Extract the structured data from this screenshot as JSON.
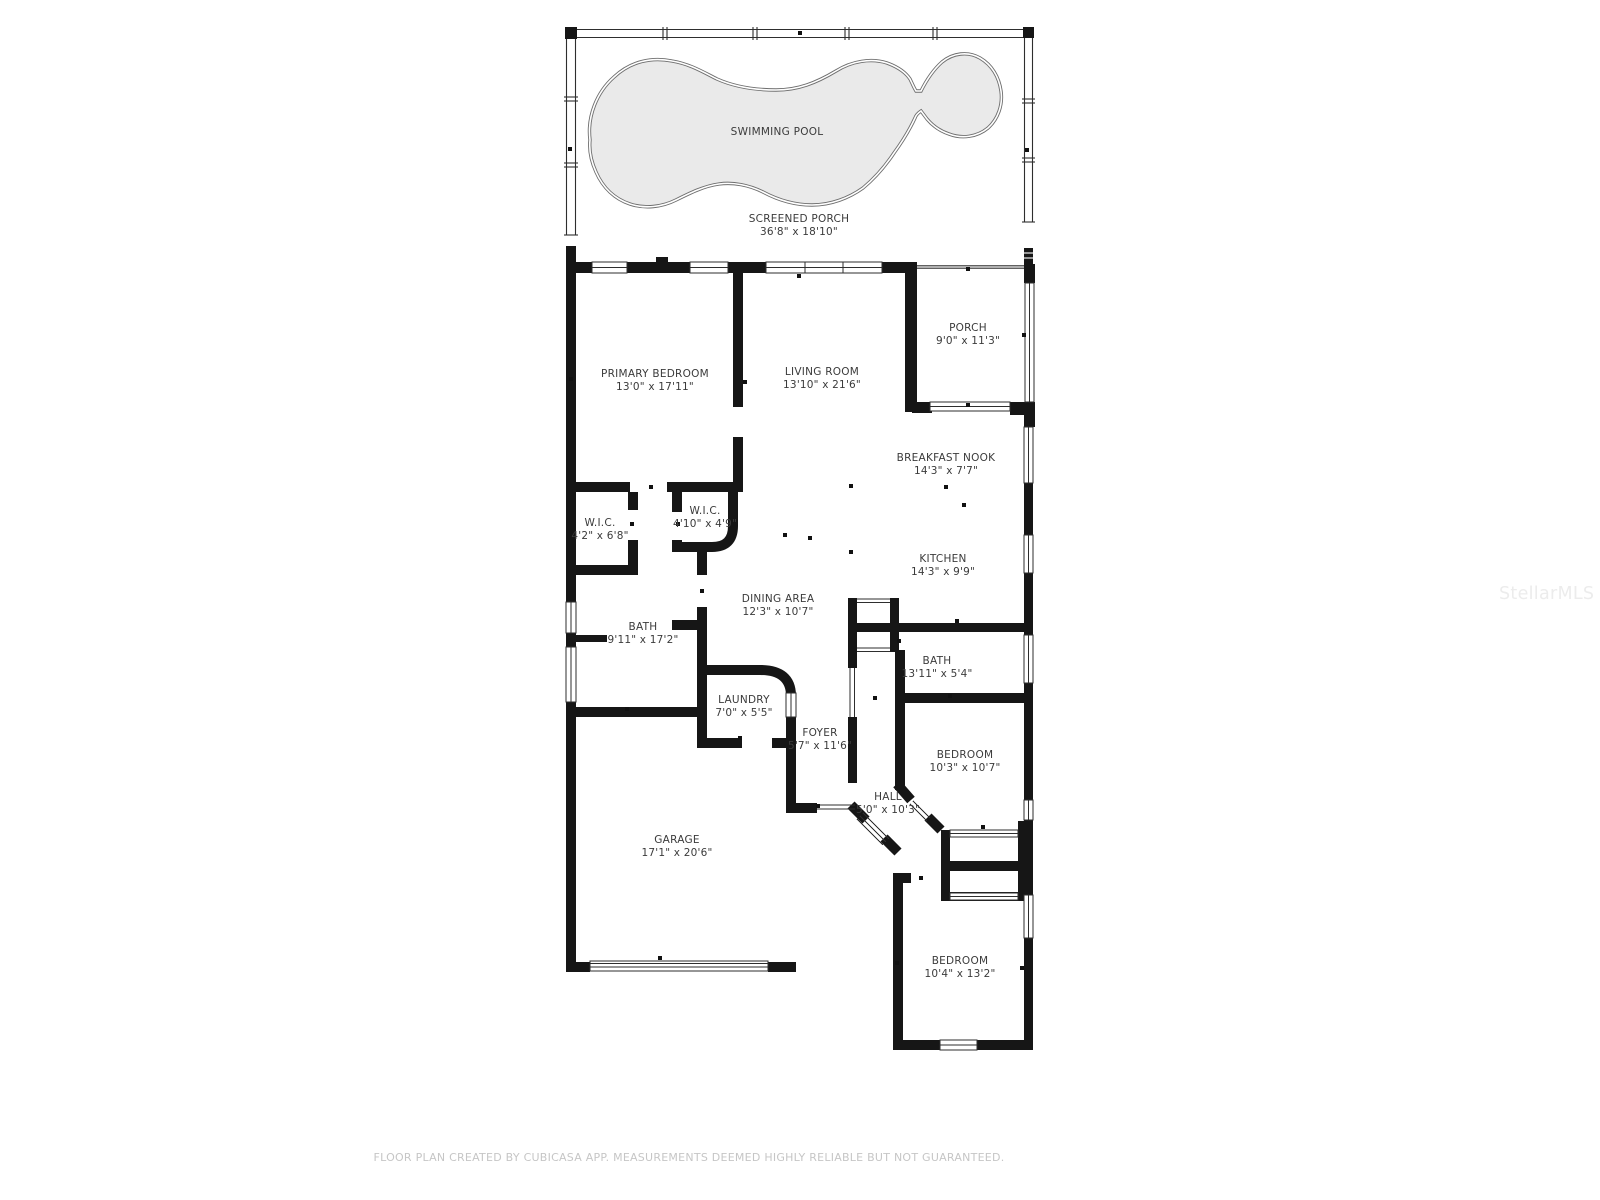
{
  "plan": {
    "title": "Floor plan",
    "footer": "FLOOR PLAN CREATED BY CUBICASA APP. MEASUREMENTS DEEMED HIGHLY RELIABLE BUT NOT GUARANTEED.",
    "watermark": "StellarMLS",
    "colors": {
      "wall": "#161616",
      "thin_line": "#2e2e2e",
      "pool_fill": "#eaeaea",
      "pool_outline": "#6e6e6e",
      "label": "#3b3b3b",
      "footer": "#c6c6c6",
      "watermark": "#ececec"
    },
    "rooms": [
      {
        "id": "swimming-pool",
        "name": "SWIMMING POOL",
        "dims": "",
        "cx": 777,
        "cy": 133
      },
      {
        "id": "screened-porch",
        "name": "SCREENED PORCH",
        "dims": "36'8\" x 18'10\"",
        "cx": 799,
        "cy": 220
      },
      {
        "id": "primary-bedroom",
        "name": "PRIMARY BEDROOM",
        "dims": "13'0\" x 17'11\"",
        "cx": 655,
        "cy": 375
      },
      {
        "id": "living-room",
        "name": "LIVING ROOM",
        "dims": "13'10\" x 21'6\"",
        "cx": 822,
        "cy": 373
      },
      {
        "id": "porch",
        "name": "PORCH",
        "dims": "9'0\" x 11'3\"",
        "cx": 968,
        "cy": 329
      },
      {
        "id": "breakfast-nook",
        "name": "BREAKFAST NOOK",
        "dims": "14'3\" x 7'7\"",
        "cx": 946,
        "cy": 459
      },
      {
        "id": "wic-1",
        "name": "W.I.C.",
        "dims": "4'2\" x 6'8\"",
        "cx": 600,
        "cy": 524
      },
      {
        "id": "wic-2",
        "name": "W.I.C.",
        "dims": "4'10\" x 4'9\"",
        "cx": 705,
        "cy": 512
      },
      {
        "id": "kitchen",
        "name": "KITCHEN",
        "dims": "14'3\" x 9'9\"",
        "cx": 943,
        "cy": 560
      },
      {
        "id": "dining-area",
        "name": "DINING AREA",
        "dims": "12'3\" x 10'7\"",
        "cx": 778,
        "cy": 600
      },
      {
        "id": "bath-1",
        "name": "BATH",
        "dims": "9'11\" x 17'2\"",
        "cx": 643,
        "cy": 628
      },
      {
        "id": "bath-2",
        "name": "BATH",
        "dims": "13'11\" x 5'4\"",
        "cx": 937,
        "cy": 662
      },
      {
        "id": "laundry",
        "name": "LAUNDRY",
        "dims": "7'0\" x 5'5\"",
        "cx": 744,
        "cy": 701
      },
      {
        "id": "foyer",
        "name": "FOYER",
        "dims": "5'7\" x 11'6\"",
        "cx": 820,
        "cy": 734
      },
      {
        "id": "bedroom-1",
        "name": "BEDROOM",
        "dims": "10'3\" x 10'7\"",
        "cx": 965,
        "cy": 756
      },
      {
        "id": "hall",
        "name": "HALL",
        "dims": "5'0\" x 10'3\"",
        "cx": 888,
        "cy": 798
      },
      {
        "id": "garage",
        "name": "GARAGE",
        "dims": "17'1\" x 20'6\"",
        "cx": 677,
        "cy": 841
      },
      {
        "id": "bedroom-2",
        "name": "BEDROOM",
        "dims": "10'4\" x 13'2\"",
        "cx": 960,
        "cy": 962
      }
    ]
  }
}
